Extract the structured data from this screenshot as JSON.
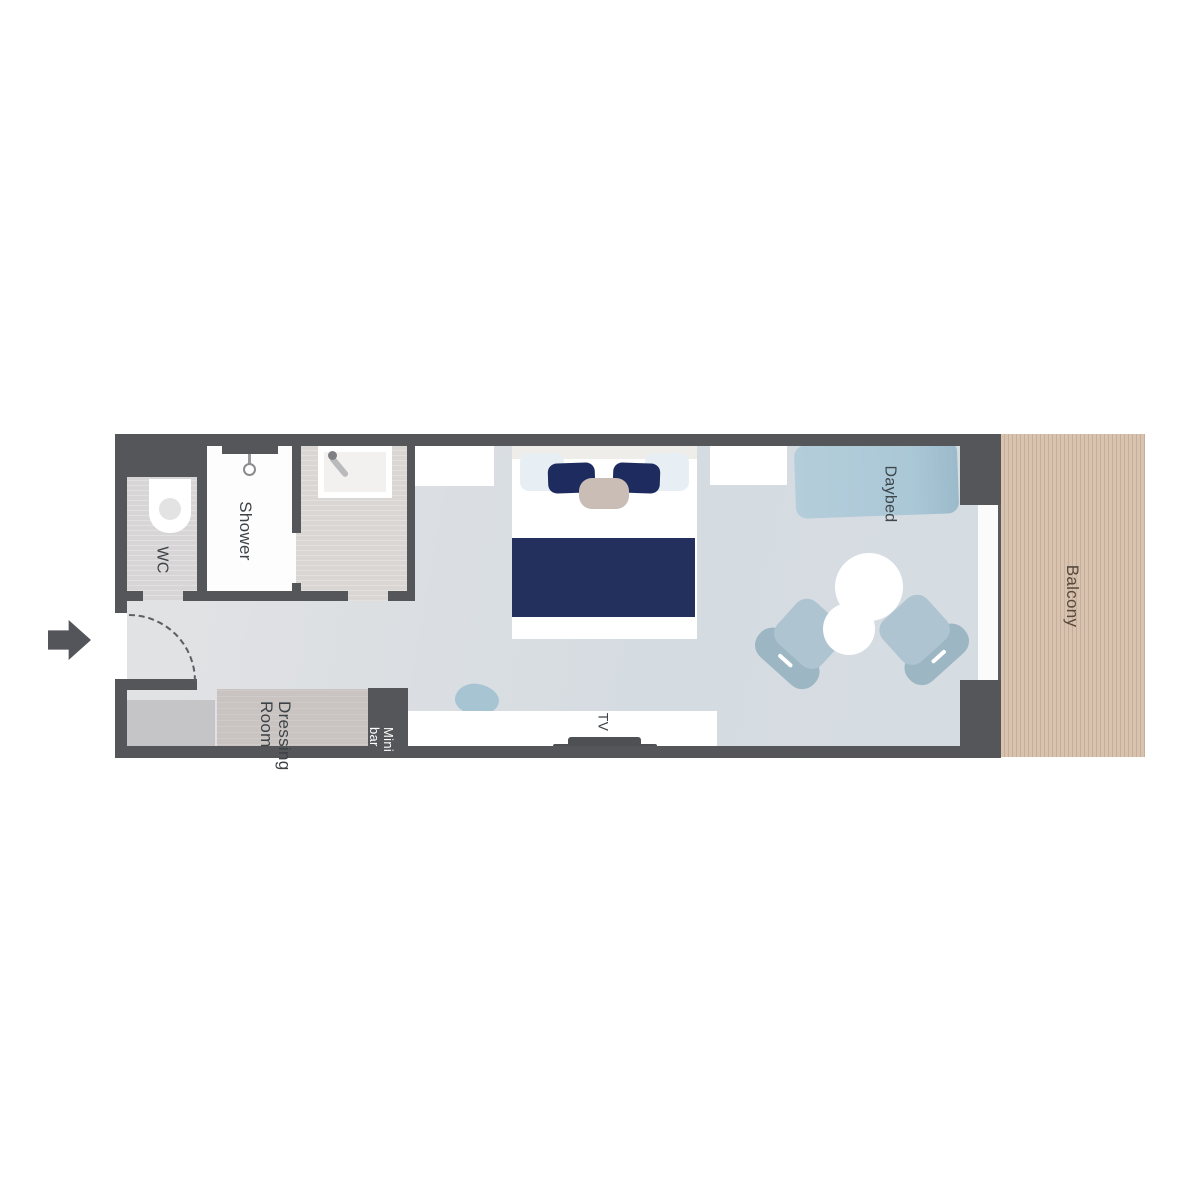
{
  "page": {
    "type": "stateroom-floor-plan",
    "background": "#ffffff"
  },
  "labels": {
    "wc": "WC",
    "shower": "Shower",
    "dressing_line1": "Dressing",
    "dressing_line2": "Room",
    "minibar_line1": "Mini",
    "minibar_line2": "bar",
    "tv": "TV",
    "daybed": "Daybed",
    "balcony": "Balcony"
  },
  "colors": {
    "wall": "#55565a",
    "floor_entry": "#e2e3e5",
    "floor_room": "#d5dce1",
    "wc_floor": "#d7d5d6",
    "shower_floor": "#fdfdfd",
    "vanity_floor": "#dad6d3",
    "bed_white": "#ffffff",
    "pillow_navy": "#1d2b5e",
    "blanket_navy": "#232f5c",
    "cushion_beige": "#c9bdb6",
    "daybed_blue": "#abc8d7",
    "chair_blue": "#aec5d1",
    "pouf_blue": "#a7c4d3",
    "dressing_gray": "#c9c3c1",
    "closet_gray": "#c5c5c7",
    "minibar_dark": "#55565a",
    "balcony_wood": "#d8c3b0",
    "balcony_stripe": "#c7ae98",
    "label_text": "#3d4247",
    "minibar_text": "#ffffff",
    "balcony_text": "#57493d"
  }
}
